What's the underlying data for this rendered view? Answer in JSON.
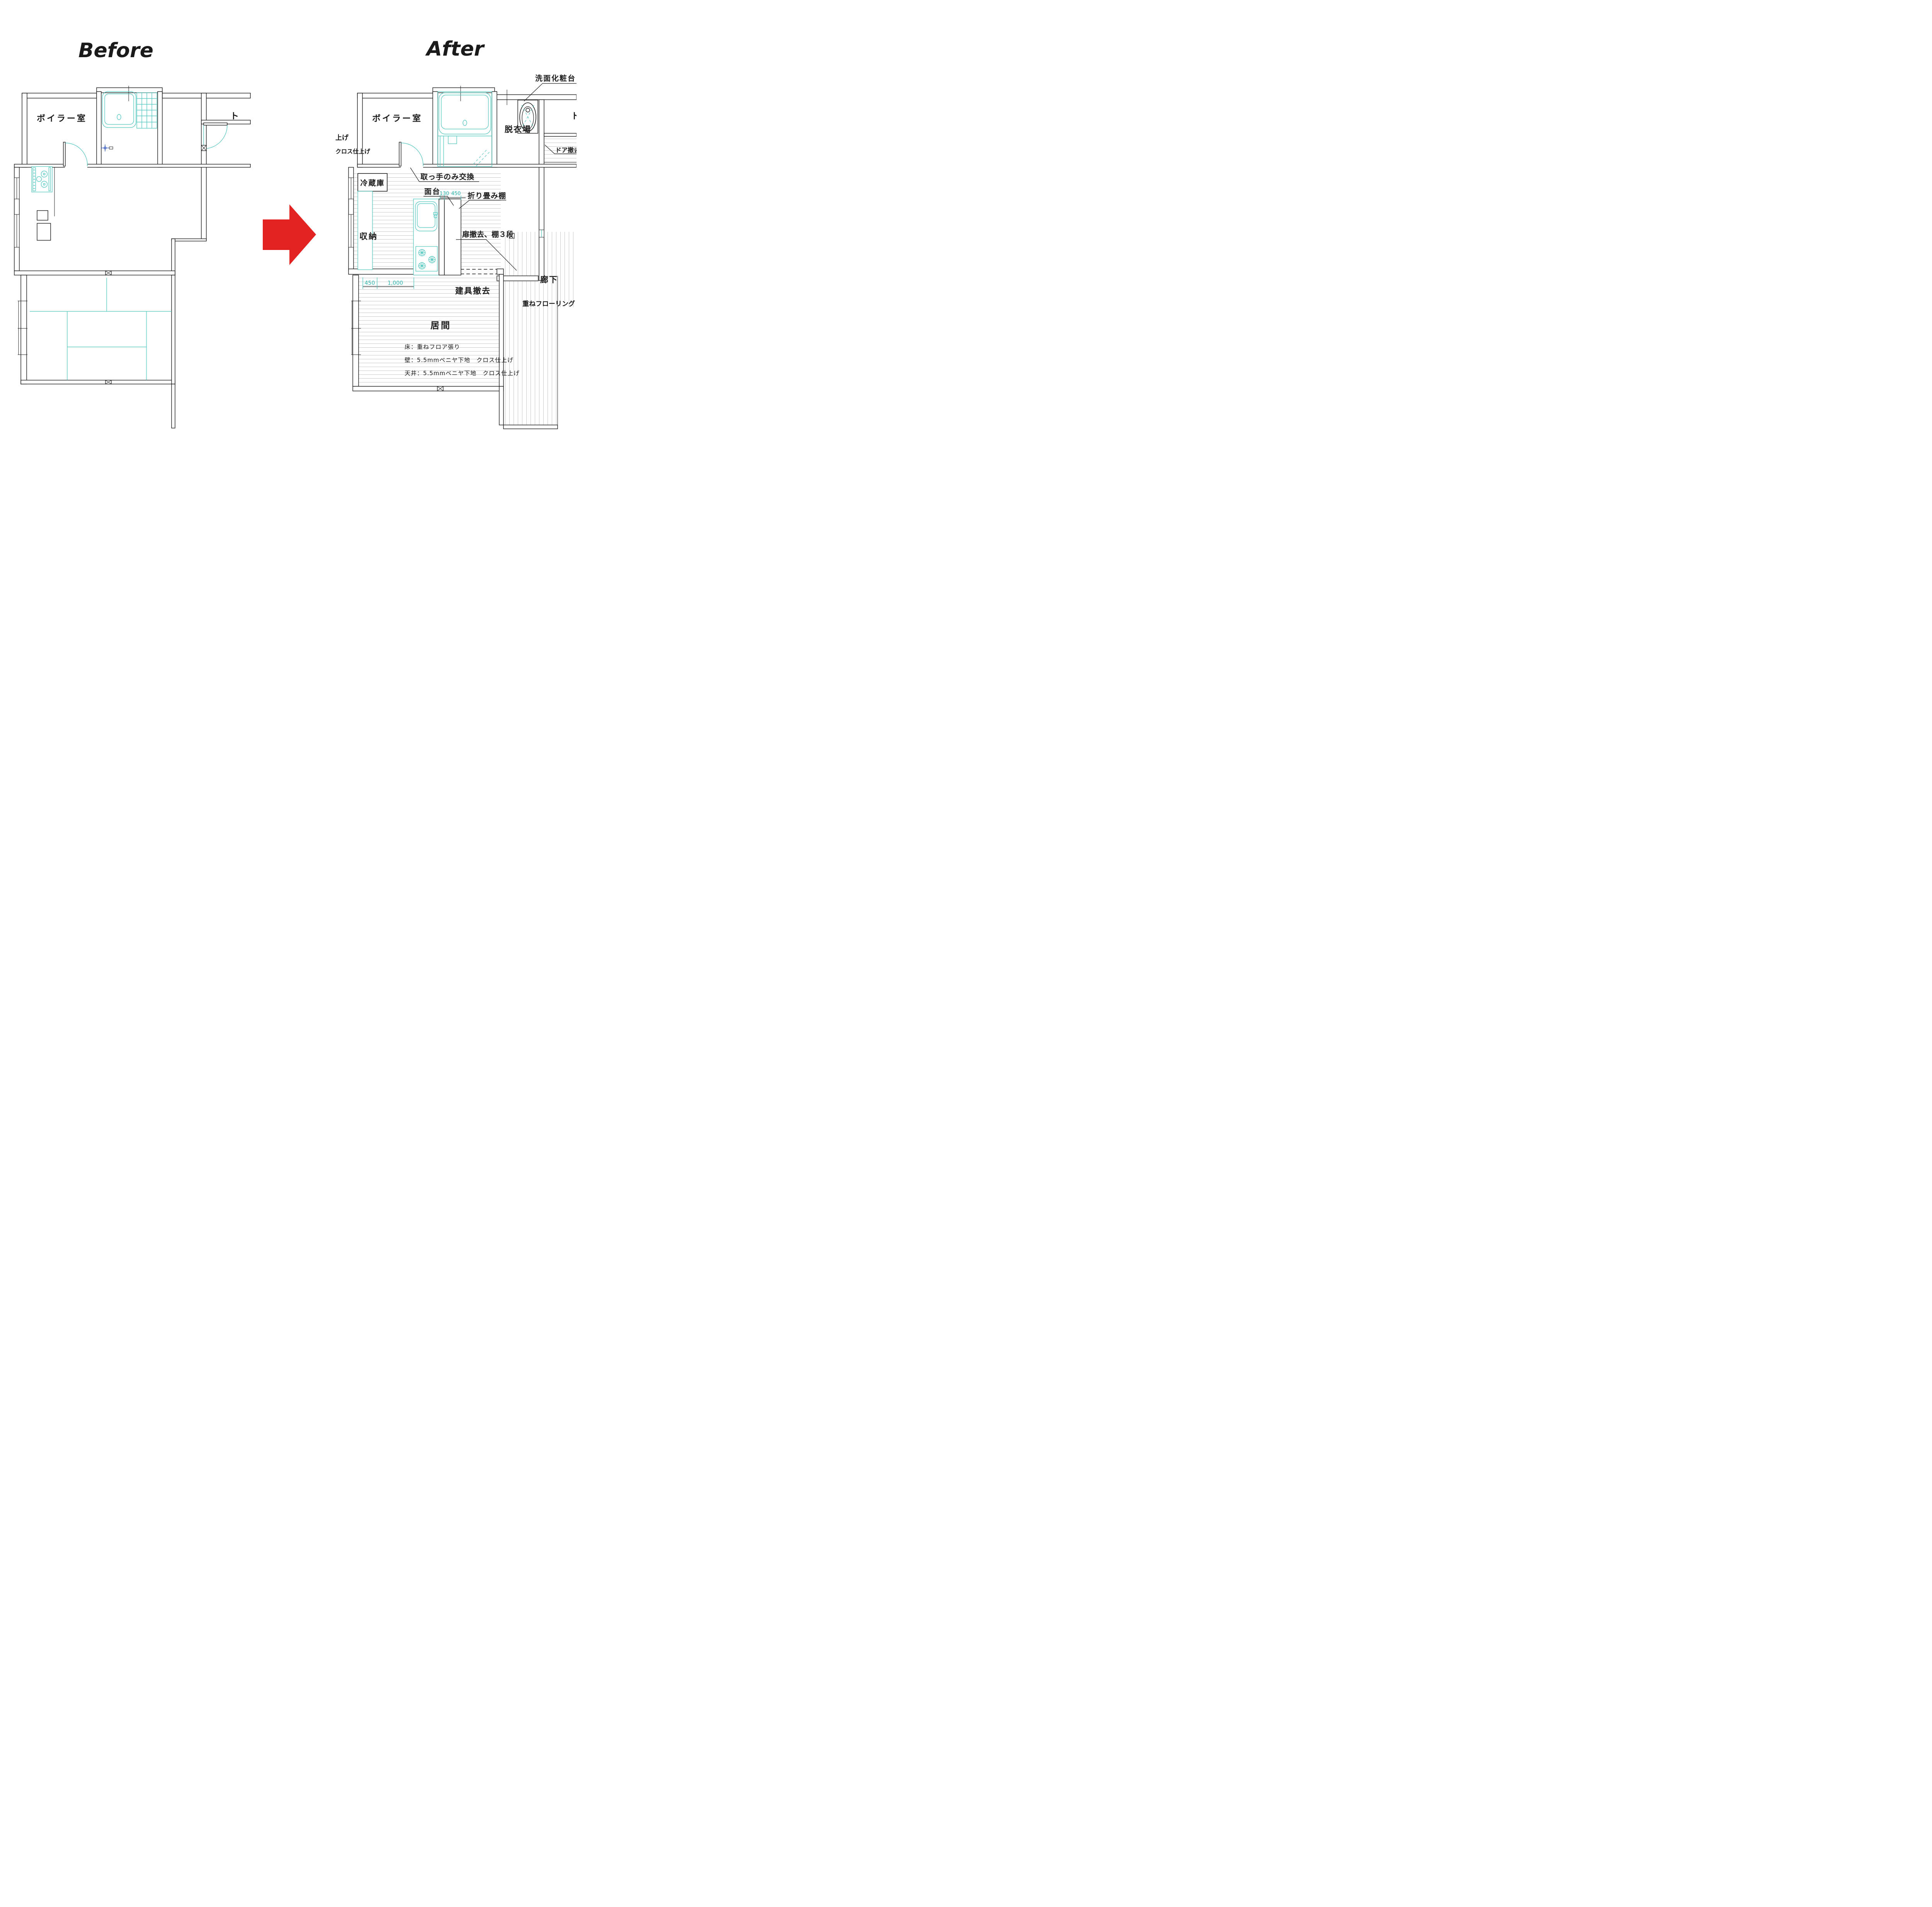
{
  "titles": {
    "before": "Before",
    "after": "After"
  },
  "colors": {
    "before_title": "#18a0dc",
    "after_title": "#e02316",
    "arrow": "#e32222",
    "line": "#1a1a1a",
    "fixture_teal": "#45c3bc",
    "hatch": "#c9c9c9"
  },
  "before": {
    "rooms": {
      "boiler": "ボイラー室",
      "toilet_partial": "ト"
    }
  },
  "after": {
    "rooms": {
      "boiler": "ボイラー室",
      "dressing": "脱衣場",
      "toilet_partial": "ト",
      "corridor": "廊下",
      "living": "居間"
    },
    "fixtures": {
      "vanity": "洗面化粧台",
      "fridge": "冷蔵庫",
      "storage": "収納",
      "counter": "面台",
      "folding_shelf": "折り畳み棚"
    },
    "notes": {
      "raise": "上げ",
      "cloth_finish": "クロス仕上げ",
      "door_removal": "ドア撤去",
      "handle_only": "取っ手のみ交換",
      "door_shelf": "扉撤去、棚３段",
      "fitting_removal": "建具撤去",
      "overlay_flooring": "重ねフローリング"
    },
    "dimensions": {
      "d130": "130",
      "d450_shelf": "450",
      "d450": "450",
      "d1000": "1,000"
    },
    "specs": {
      "floor": "床：重ねフロア張り",
      "wall": "壁：5.5mmベニヤ下地　クロス仕上げ",
      "ceiling": "天井：5.5mmベニヤ下地　クロス仕上げ"
    }
  }
}
